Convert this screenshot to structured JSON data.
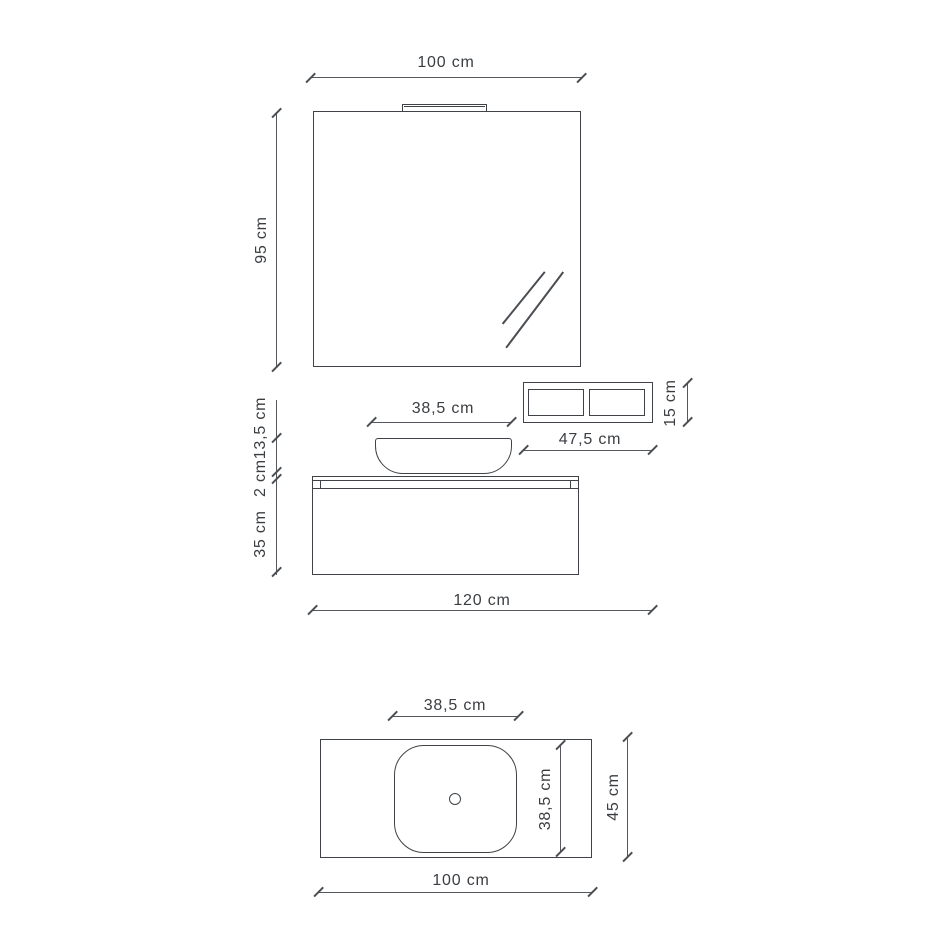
{
  "diagram_title": "Bathroom vanity composition dimension drawing",
  "colors": {
    "background": "#ffffff",
    "outline": "#3f4347",
    "dimension_line": "#55595d",
    "text": "#3a3e42"
  },
  "front_view": {
    "labels": {
      "mirror_width": "100 cm",
      "mirror_height": "95 cm",
      "shelf_width": "47,5 cm",
      "shelf_height": "15 cm",
      "basin_width": "38,5 cm",
      "basin_height": "13,5 cm",
      "top_thickness": "2 cm",
      "cabinet_height": "35 cm",
      "total_width": "120 cm"
    }
  },
  "top_view": {
    "labels": {
      "sink_width": "38,5 cm",
      "sink_depth": "38,5 cm",
      "counter_depth": "45 cm",
      "counter_width": "100 cm"
    }
  }
}
